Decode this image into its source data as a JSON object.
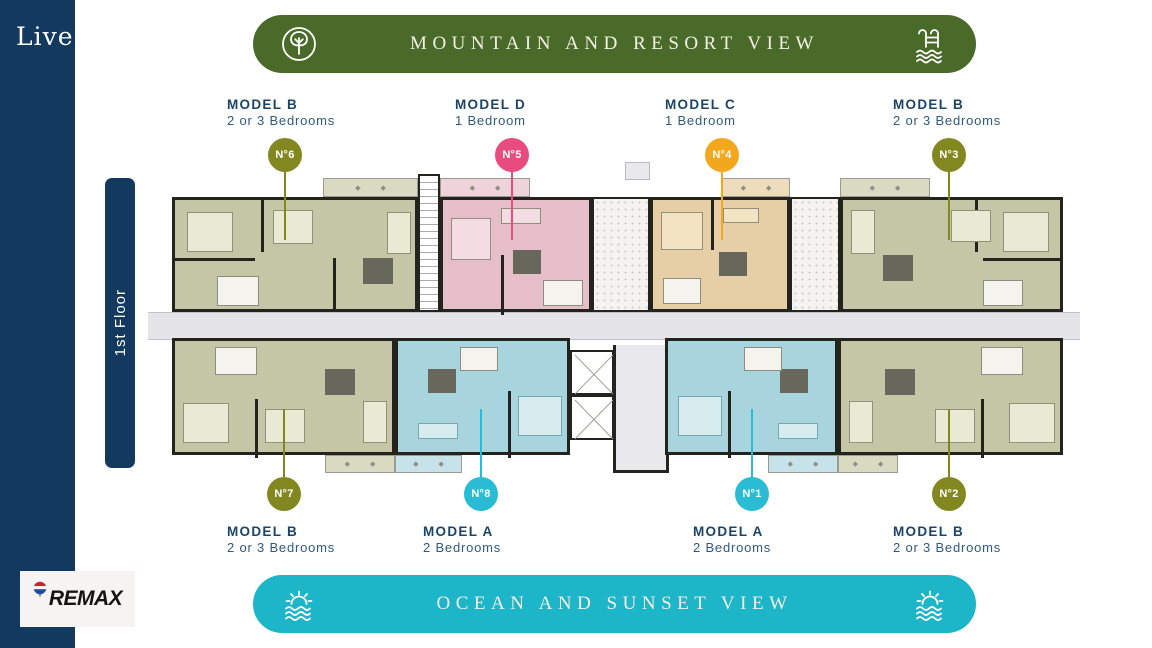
{
  "sidebar": {
    "logo_text": "Live"
  },
  "floor_badge": {
    "label": "1st Floor"
  },
  "top_banner": {
    "text": "MOUNTAIN AND RESORT VIEW",
    "bg_color": "#4a6a29",
    "left_icon": "tree-icon",
    "right_icon": "pool-ladder-icon"
  },
  "bottom_banner": {
    "text": "OCEAN AND SUNSET VIEW",
    "bg_color": "#1db5c8",
    "left_icon": "sunset-waves-icon",
    "right_icon": "sunset-waves-icon"
  },
  "badge_colors": {
    "olive": "#82871f",
    "pink": "#e84b7d",
    "orange": "#f2a71d",
    "cyan": "#29bcd4"
  },
  "plan_colors": {
    "olive_unit": "#c5c6a6",
    "pink_unit": "#e5bec9",
    "tan_unit": "#e6cfa6",
    "cyan_unit": "#a8d4dd",
    "corridor": "#e4e4e9",
    "walls": "#24241f"
  },
  "top_units": [
    {
      "model": "MODEL B",
      "bedrooms": "2 or 3 Bedrooms",
      "number": "N°6",
      "color": "olive"
    },
    {
      "model": "MODEL D",
      "bedrooms": "1 Bedroom",
      "number": "N°5",
      "color": "pink"
    },
    {
      "model": "MODEL C",
      "bedrooms": "1 Bedroom",
      "number": "N°4",
      "color": "orange"
    },
    {
      "model": "MODEL B",
      "bedrooms": "2 or 3 Bedrooms",
      "number": "N°3",
      "color": "olive"
    }
  ],
  "bottom_units": [
    {
      "model": "MODEL B",
      "bedrooms": "2 or 3 Bedrooms",
      "number": "N°7",
      "color": "olive"
    },
    {
      "model": "MODEL A",
      "bedrooms": "2 Bedrooms",
      "number": "N°8",
      "color": "cyan"
    },
    {
      "model": "MODEL A",
      "bedrooms": "2 Bedrooms",
      "number": "N°1",
      "color": "cyan"
    },
    {
      "model": "MODEL B",
      "bedrooms": "2 or 3 Bedrooms",
      "number": "N°2",
      "color": "olive"
    }
  ],
  "remax": {
    "text": "REMAX"
  }
}
